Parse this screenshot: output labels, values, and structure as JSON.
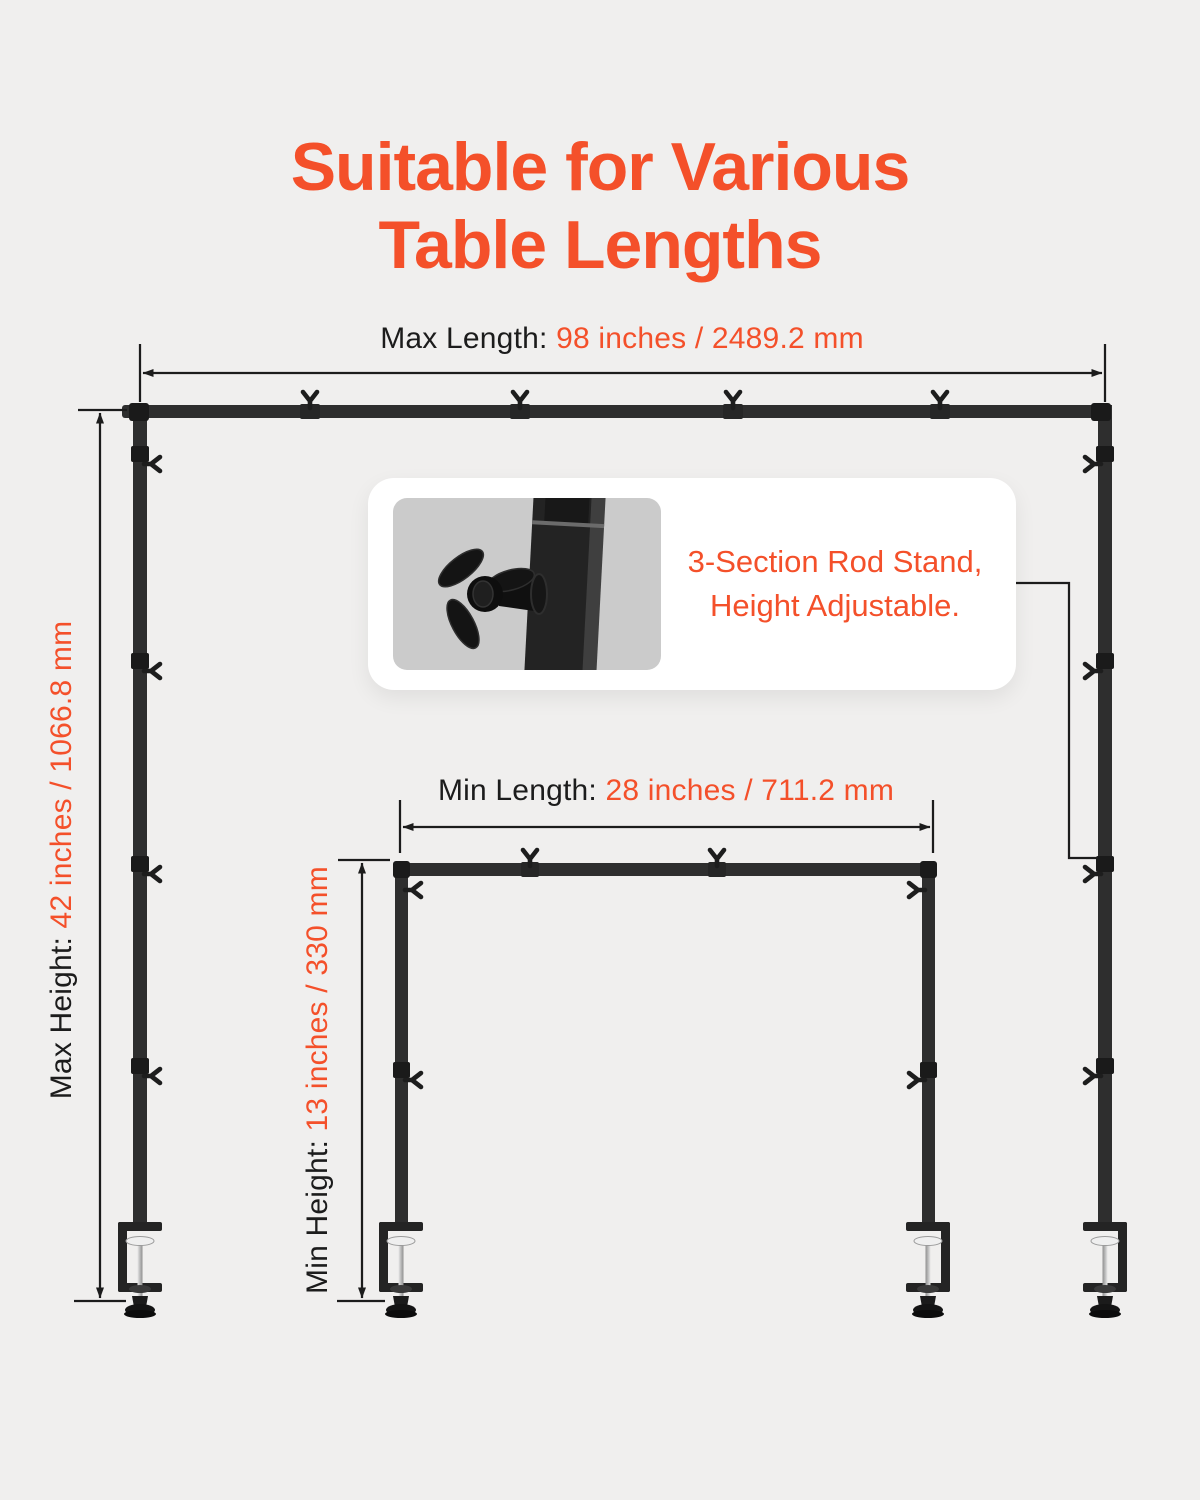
{
  "title": {
    "line1": "Suitable for Various",
    "line2": "Table Lengths"
  },
  "colors": {
    "accent": "#F4502A",
    "ink": "#1C1C1C",
    "background": "#F0EFEE",
    "rod": "#2E2E2E",
    "rod_dark": "#1A1A1A",
    "card_bg": "#FFFFFF",
    "inset_bg": "#CBCBCB"
  },
  "dimensions": {
    "max_length": {
      "label": "Max Length:",
      "value": "98 inches / 2489.2 mm"
    },
    "min_length": {
      "label": "Min Length:",
      "value": "28 inches / 711.2 mm"
    },
    "max_height": {
      "label": "Max Height:",
      "value": "42 inches / 1066.8 mm"
    },
    "min_height": {
      "label": "Min Height:",
      "value": "13 inches / 330 mm"
    }
  },
  "callout": {
    "line1": "3-Section Rod Stand,",
    "line2": "Height Adjustable."
  },
  "icons": {
    "wing_nut": "Y-shaped fork glyph",
    "desk_clamp": "C-clamp with screw and foot knob",
    "dimension_arrow": "solid triangular arrowhead"
  }
}
